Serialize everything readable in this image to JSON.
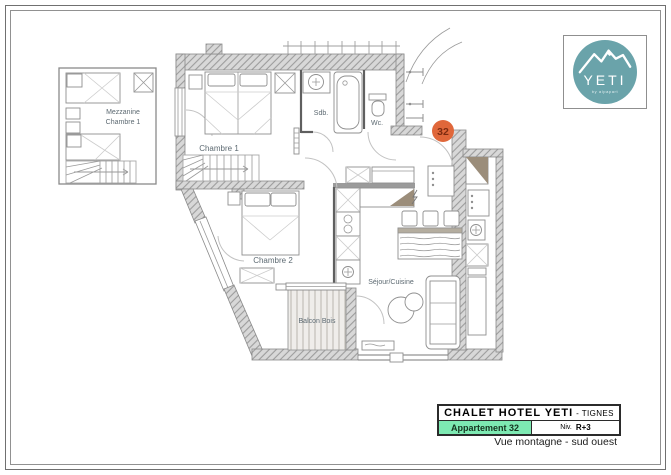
{
  "logo": {
    "brand": "YETI",
    "tagline": "by alpapart"
  },
  "badge": {
    "number": "32"
  },
  "plan_labels": {
    "mezzanine_line1": "Mezzanine",
    "mezzanine_line2": "Chambre 1",
    "chambre1": "Chambre 1",
    "chambre2": "Chambre 2",
    "sdb": "Sdb.",
    "wc": "Wc.",
    "sejour": "Séjour/Cuisine",
    "balcon": "Balcon Bois"
  },
  "title_block": {
    "hotel": "CHALET HOTEL YETI",
    "city": "- TIGNES",
    "apartment": "Appartement 32",
    "level_label": "Niv.",
    "level": "R+3",
    "view": "Vue montagne - sud ouest"
  },
  "colors": {
    "badge_orange": "#e0673a",
    "badge_text": "#7c2b10",
    "logo_teal": "#6aa3aa",
    "accent_green": "#7de9b2",
    "wall_hatch_gray": "#d8d8d8",
    "shade_taupe": "#9b8d7a"
  }
}
